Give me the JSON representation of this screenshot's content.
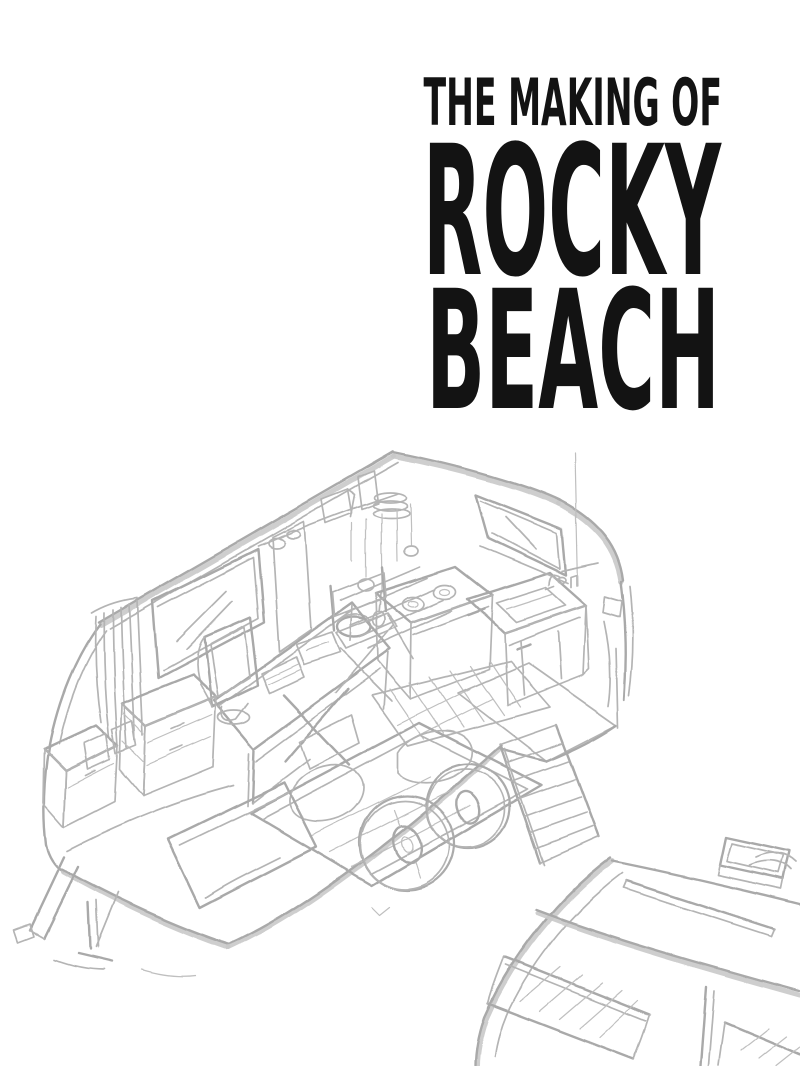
{
  "page": {
    "background": "#ffffff",
    "width": 800,
    "height": 1066
  },
  "title": {
    "kicker": "THE MAKING OF",
    "line1": "ROCKY",
    "line2": "BEACH",
    "color": "#131313"
  },
  "artwork": {
    "pencil_color": "#b2b2b2",
    "main_sketch_label": "Pencil concept sketch: cutaway of a camper trailer showing a desk with computer monitor and keyboard, director's chair, folding chair, kitchenette with two-burner stove and sink, wall shelves with dishes and hanging utensils, windows with curtains, chests of drawers, bed with pillows, striped rug, entry ramp, tandem wheels and a tow hitch",
    "secondary_sketch_label": "Pencil sketch of a second trailer's curved roof with roof vent and hatched windows, partially visible in the bottom-right corner"
  }
}
